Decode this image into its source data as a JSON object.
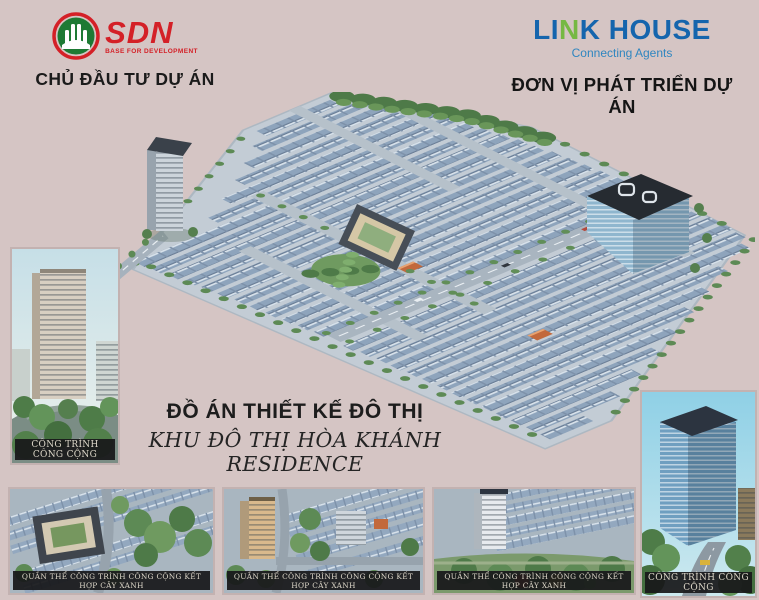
{
  "brand": {
    "background_color": "#d5c5c4",
    "sdn_red": "#d42027",
    "sdn_green": "#1e7a34",
    "linkhouse_blue": "#1565ad",
    "linkhouse_green": "#76b843"
  },
  "developer_block": {
    "logo_name": "SDN",
    "logo_tagline": "BASE FOR DEVELOPMENT",
    "label": "CHỦ ĐẦU TƯ DỰ ÁN"
  },
  "agency_block": {
    "logo_part1": "LI",
    "logo_part2": "N",
    "logo_part3": "K HOUSE",
    "logo_tagline": "Connecting Agents",
    "label": "ĐƠN VỊ PHÁT TRIỂN DỰ ÁN"
  },
  "title": {
    "main": "ĐỒ ÁN THIẾT KẾ ĐÔ THỊ",
    "sub": "KHU ĐÔ THỊ HÒA KHÁNH RESIDENCE"
  },
  "gallery": {
    "left": {
      "caption": "CÔNG TRÌNH CÔNG CỘNG"
    },
    "right": {
      "caption": "CÔNG TRÌNH CÔNG CỘNG"
    },
    "bottom": [
      {
        "caption": "QUẦN THỂ CÔNG TRÌNH CÔNG CỘNG KẾT HỢP CÂY XANH"
      },
      {
        "caption": "QUẦN THỂ CÔNG TRÌNH CÔNG CỘNG KẾT HỢP CÂY XANH"
      },
      {
        "caption": "QUẦN THỂ CÔNG TRÌNH CÔNG CỘNG KẾT HỢP CÂY XANH"
      }
    ]
  }
}
